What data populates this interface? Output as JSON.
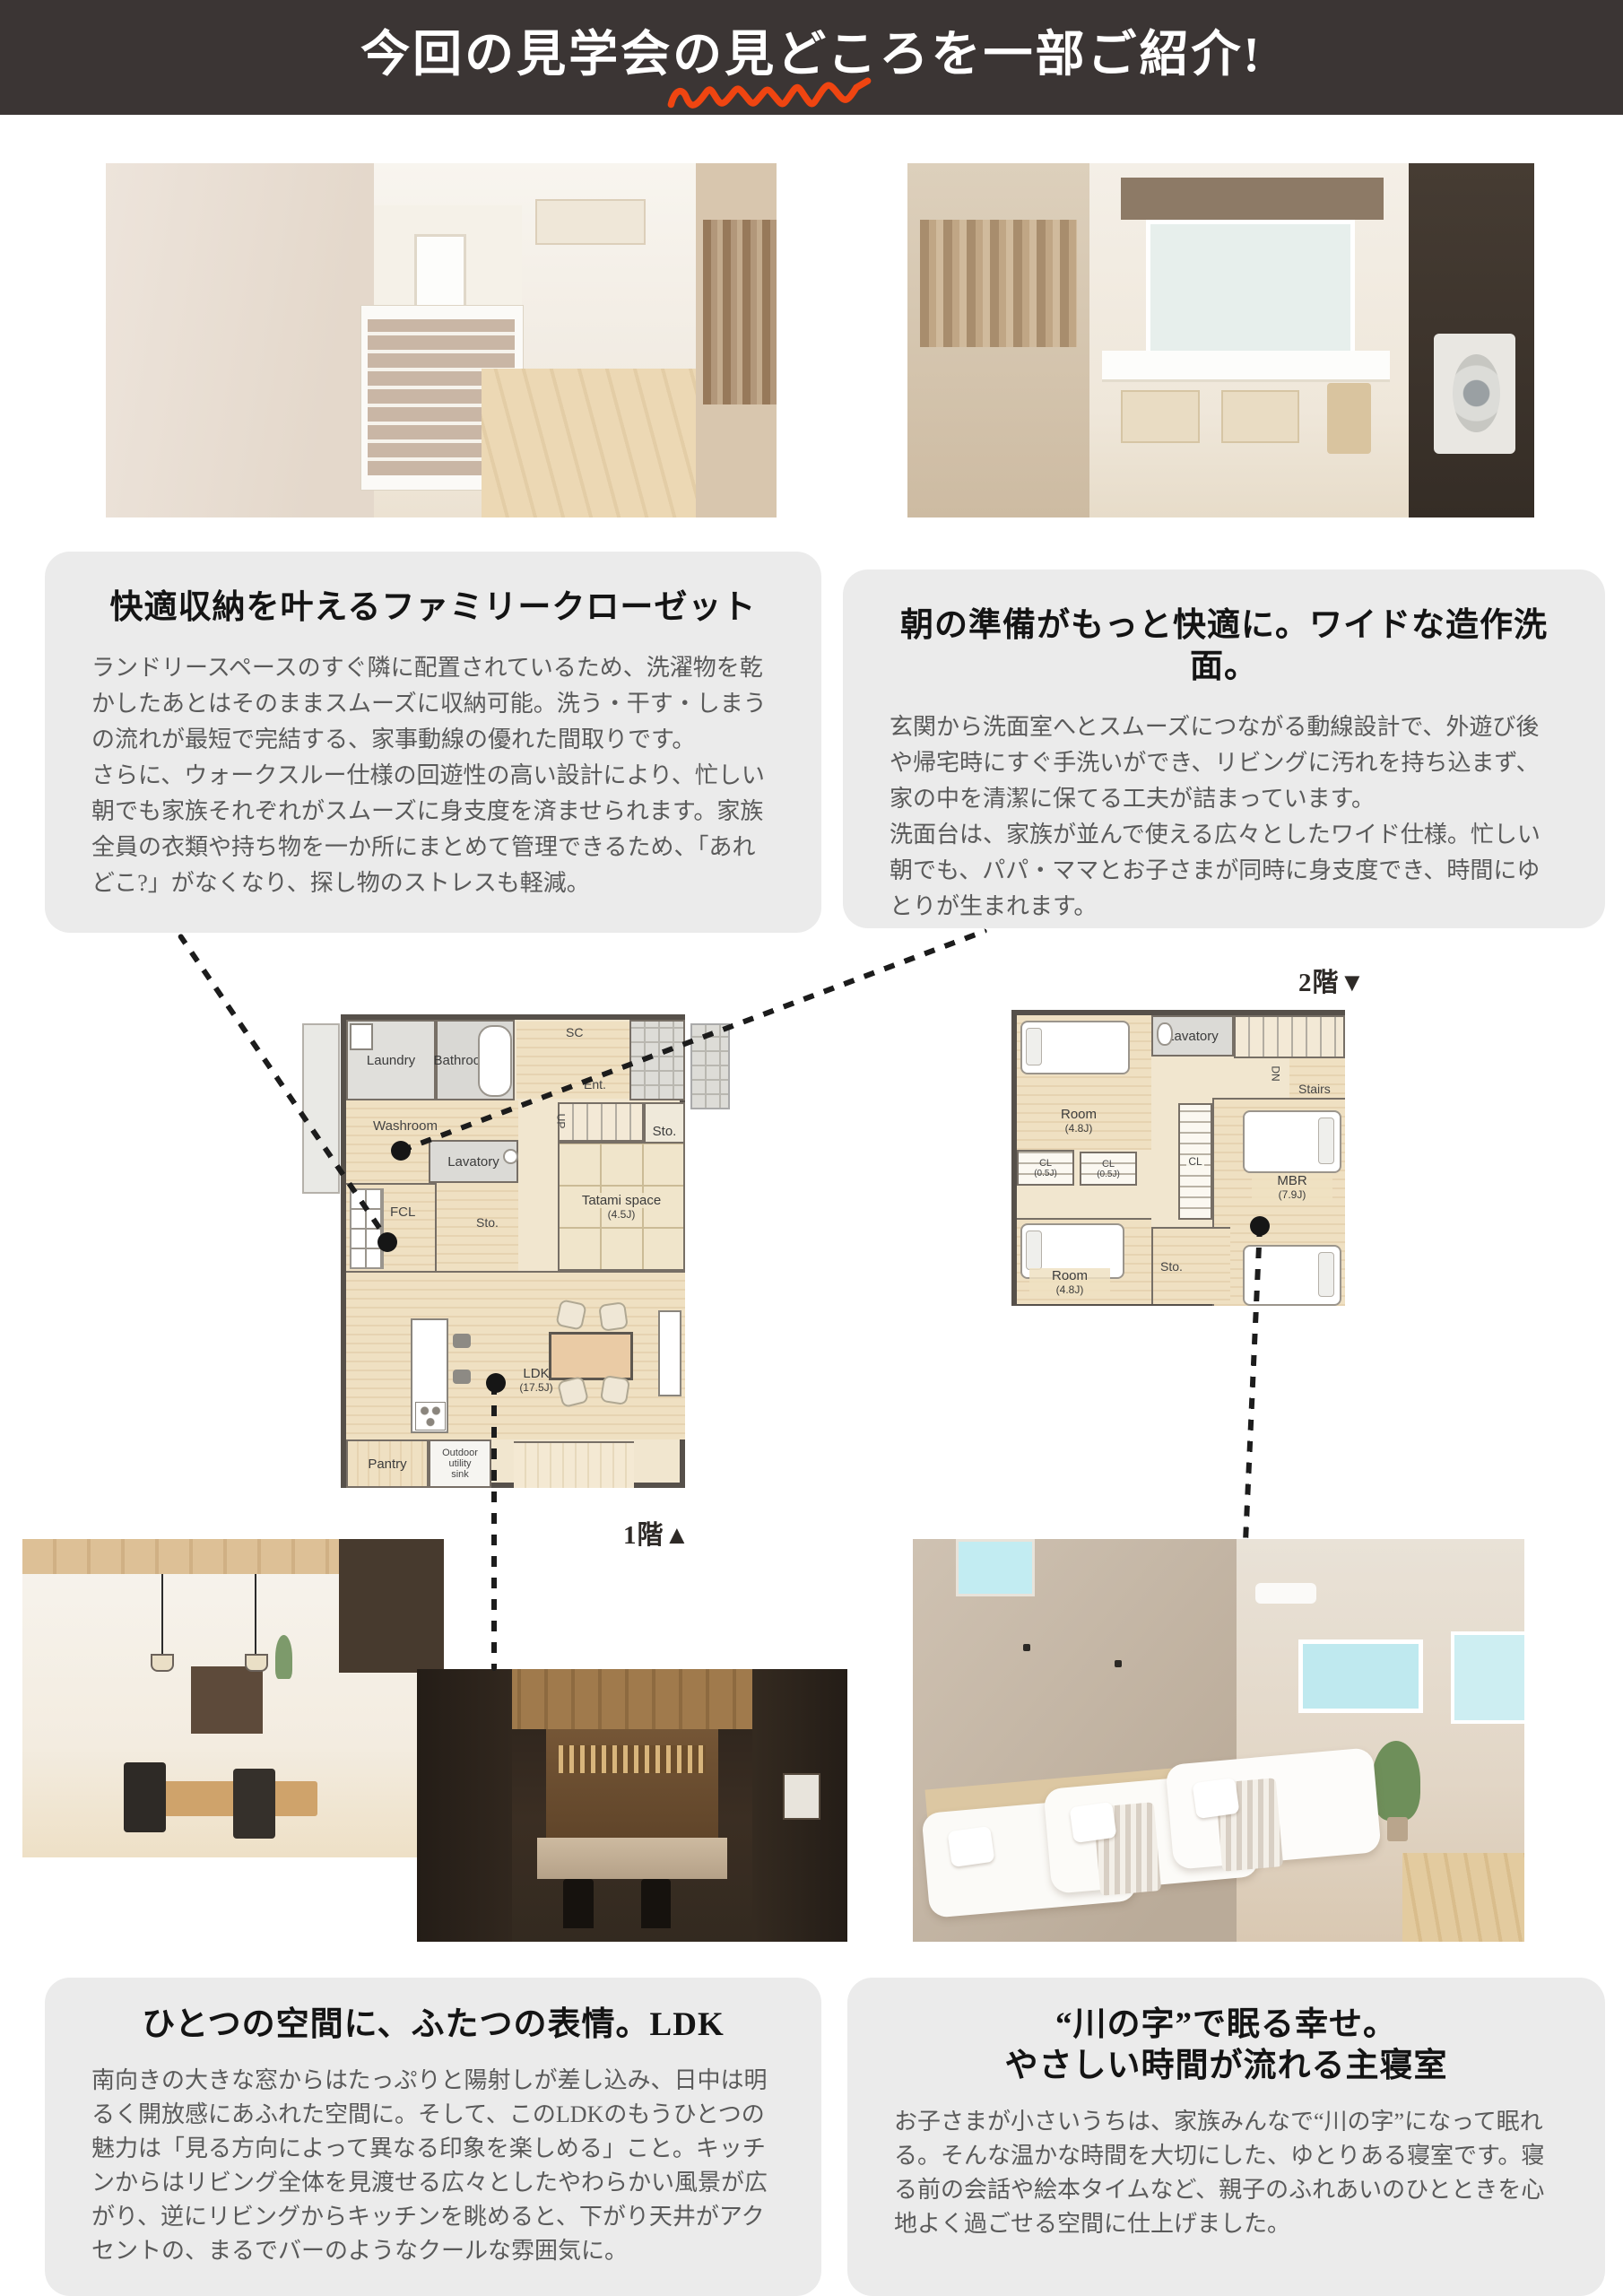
{
  "header": {
    "title": "今回の見学会の見どころを一部ご紹介!"
  },
  "colors": {
    "header_bg": "#3b3534",
    "accent": "#ef4511",
    "box_bg": "#ebebeb"
  },
  "floor_labels": {
    "first": "1階▲",
    "second": "2階▼"
  },
  "boxes": {
    "closet": {
      "heading": "快適収納を叶えるファミリークローゼット",
      "body": "ランドリースペースのすぐ隣に配置されているため、洗濯物を乾かしたあとはそのままスムーズに収納可能。洗う・干す・しまうの流れが最短で完結する、家事動線の優れた間取りです。\nさらに、ウォークスルー仕様の回遊性の高い設計により、忙しい朝でも家族それぞれがスムーズに身支度を済ませられます。家族全員の衣類や持ち物を一か所にまとめて管理できるため、「あれどこ?」がなくなり、探し物のストレスも軽減。"
    },
    "washstand": {
      "heading": "朝の準備がもっと快適に。ワイドな造作洗面。",
      "body": "玄関から洗面室へとスムーズにつながる動線設計で、外遊び後や帰宅時にすぐ手洗いができ、リビングに汚れを持ち込まず、家の中を清潔に保てる工夫が詰まっています。\n洗面台は、家族が並んで使える広々としたワイド仕様。忙しい朝でも、パパ・ママとお子さまが同時に身支度でき、時間にゆとりが生まれます。"
    },
    "ldk": {
      "heading": "ひとつの空間に、ふたつの表情。LDK",
      "body": "南向きの大きな窓からはたっぷりと陽射しが差し込み、日中は明るく開放感にあふれた空間に。そして、このLDKのもうひとつの魅力は「見る方向によって異なる印象を楽しめる」こと。キッチンからはリビング全体を見渡せる広々としたやわらかい風景が広がり、逆にリビングからキッチンを眺めると、下がり天井がアクセントの、まるでバーのようなクールな雰囲気に。"
    },
    "bedroom": {
      "heading1": "“川の字”で眠る幸せ。",
      "heading2": "やさしい時間が流れる主寝室",
      "body": "お子さまが小さいうちは、家族みんなで“川の字”になって眠れる。そんな温かな時間を大切にした、ゆとりある寝室です。寝る前の会話や絵本タイムなど、親子のふれあいのひとときを心地よく過ごせる空間に仕上げました。"
    }
  },
  "plan1f": {
    "laundry": "Laundry",
    "bathroom": "Bathroom",
    "sc": "SC",
    "ent": "Ent.",
    "washroom": "Washroom",
    "up": "UP",
    "sto_top": "Sto.",
    "lavatory": "Lavatory",
    "fcl": "FCL",
    "sto_mid": "Sto.",
    "tatami": "Tatami space",
    "tatami_size": "(4.5J)",
    "ldk": "LDK",
    "ldk_size": "(17.5J)",
    "pantry": "Pantry",
    "outdoor1": "Outdoor",
    "outdoor2": "utility",
    "outdoor3": "sink"
  },
  "plan2f": {
    "lavatory": "Lavatory",
    "dn": "DN",
    "stairs": "Stairs",
    "room_top": "Room",
    "room_top_size": "(4.8J)",
    "cl1": "CL",
    "cl1_size": "(0.5J)",
    "cl2": "CL",
    "cl2_size": "(0.5J)",
    "cl_center": "CL",
    "mbr": "MBR",
    "mbr_size": "(7.9J)",
    "room_bottom": "Room",
    "room_bottom_size": "(4.8J)",
    "sto": "Sto."
  }
}
